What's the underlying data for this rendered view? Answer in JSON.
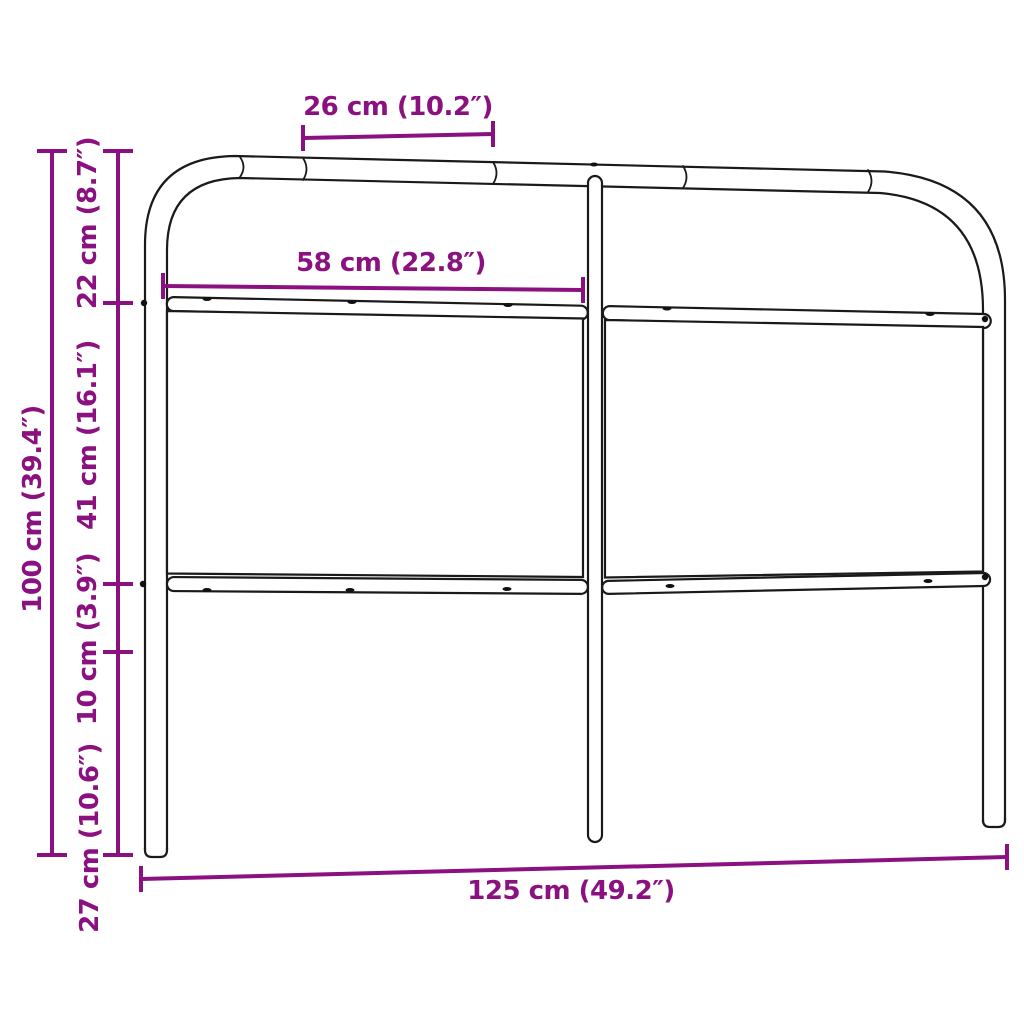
{
  "diagram": {
    "type": "product-dimension-line-drawing",
    "subject": "metal headboard with two panels, three legs and tubular top frame",
    "accent_color": "#8A117F",
    "line_color": "#1a1a1a",
    "background_color": "#ffffff",
    "dimensions": {
      "top_tube_segment": "26 cm (10.2″)",
      "panel_width": "58 cm (22.8″)",
      "upper_section_height": "22 cm (8.7″)",
      "panel_section_height": "41 cm (16.1″)",
      "gap_below_panel_height": "10 cm (3.9″)",
      "leg_height": "27 cm (10.6″)",
      "total_height": "100 cm (39.4″)",
      "total_width": "125 cm (49.2″)"
    }
  }
}
